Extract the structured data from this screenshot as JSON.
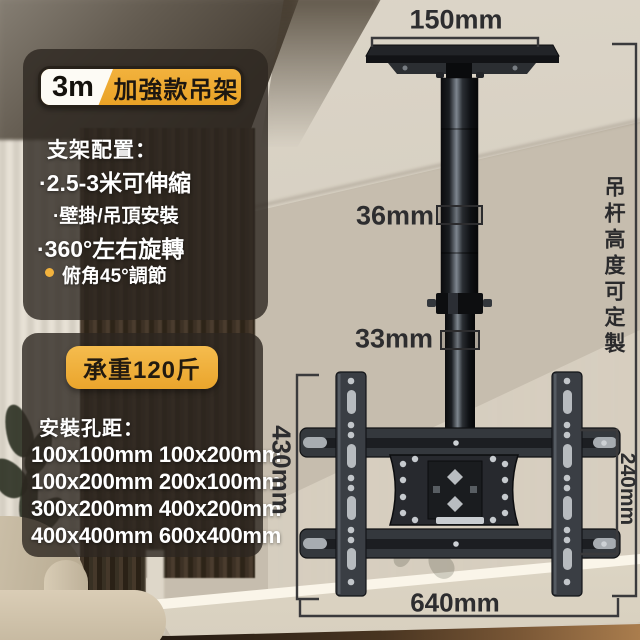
{
  "badge": {
    "spec": "3m",
    "name": "加強款吊架"
  },
  "features": {
    "heading": "支架配置：",
    "items": [
      "·2.5-3米可伸縮",
      "·壁掛/吊頂安裝",
      "·360°左右旋轉",
      "俯角45°調節"
    ]
  },
  "capacity": {
    "label": "承重120斤"
  },
  "mounting_holes": {
    "heading": "安裝孔距：",
    "rows": [
      "100x100mm 100x200mm",
      "100x200mm 200x100mm",
      "300x200mm 400x200mm",
      "400x400mm 600x400mm"
    ]
  },
  "measurements": {
    "ceiling_plate_width": "150mm",
    "upper_pole_diameter": "36mm",
    "lower_pole_diameter": "33mm",
    "bracket_height": "430mm",
    "rail_span": "240mm",
    "bracket_width": "640mm"
  },
  "notes": {
    "pole_height": "吊杆高度可定製"
  },
  "colors": {
    "gold": "#f2b23d",
    "gold-dark": "#e9a226",
    "panel": "rgba(45,39,32,0.8)",
    "ink": "#2d2d2f",
    "text-light": "#ffffff"
  }
}
